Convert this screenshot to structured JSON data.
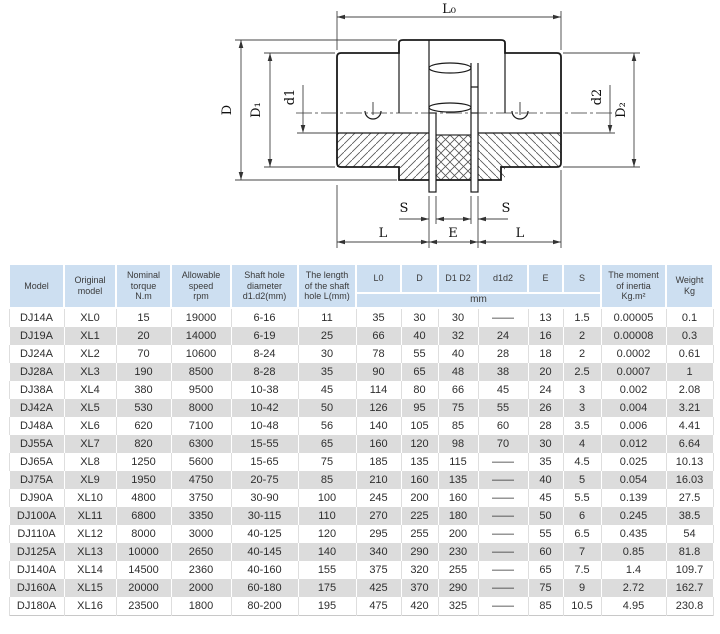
{
  "drawing": {
    "labels": {
      "l0": "L₀",
      "D": "D",
      "D1": "D₁",
      "d1": "d1",
      "d2": "d2",
      "D2": "D₂",
      "S": "S",
      "E": "E",
      "L": "L"
    }
  },
  "table": {
    "headers": {
      "model": "Model",
      "original_model": "Original\nmodel",
      "nominal_torque": "Nominal\ntorque\nN.m",
      "allowable_speed": "Allowable\nspeed\nrpm",
      "shaft_hole": "Shaft hole\ndiameter\nd1.d2(mm)",
      "shaft_length": "The length\nof the shaft\nhole L(mm)",
      "dims": [
        "L0",
        "D",
        "D1 D2",
        "d1d2",
        "E",
        "S"
      ],
      "dims_unit": "mm",
      "inertia": "The moment\nof inertia\nKg.m²",
      "weight": "Weight\nKg"
    },
    "rows": [
      [
        "DJ14A",
        "XL0",
        "15",
        "19000",
        "6-16",
        "11",
        "35",
        "30",
        "30",
        "——",
        "13",
        "1.5",
        "0.00005",
        "0.1"
      ],
      [
        "DJ19A",
        "XL1",
        "20",
        "14000",
        "6-19",
        "25",
        "66",
        "40",
        "32",
        "24",
        "16",
        "2",
        "0.00008",
        "0.3"
      ],
      [
        "DJ24A",
        "XL2",
        "70",
        "10600",
        "8-24",
        "30",
        "78",
        "55",
        "40",
        "28",
        "18",
        "2",
        "0.0002",
        "0.61"
      ],
      [
        "DJ28A",
        "XL3",
        "190",
        "8500",
        "8-28",
        "35",
        "90",
        "65",
        "48",
        "38",
        "20",
        "2.5",
        "0.0007",
        "1"
      ],
      [
        "DJ38A",
        "XL4",
        "380",
        "9500",
        "10-38",
        "45",
        "114",
        "80",
        "66",
        "45",
        "24",
        "3",
        "0.002",
        "2.08"
      ],
      [
        "DJ42A",
        "XL5",
        "530",
        "8000",
        "10-42",
        "50",
        "126",
        "95",
        "75",
        "55",
        "26",
        "3",
        "0.004",
        "3.21"
      ],
      [
        "DJ48A",
        "XL6",
        "620",
        "7100",
        "10-48",
        "56",
        "140",
        "105",
        "85",
        "60",
        "28",
        "3.5",
        "0.006",
        "4.41"
      ],
      [
        "DJ55A",
        "XL7",
        "820",
        "6300",
        "15-55",
        "65",
        "160",
        "120",
        "98",
        "70",
        "30",
        "4",
        "0.012",
        "6.64"
      ],
      [
        "DJ65A",
        "XL8",
        "1250",
        "5600",
        "15-65",
        "75",
        "185",
        "135",
        "115",
        "——",
        "35",
        "4.5",
        "0.025",
        "10.13"
      ],
      [
        "DJ75A",
        "XL9",
        "1950",
        "4750",
        "20-75",
        "85",
        "210",
        "160",
        "135",
        "——",
        "40",
        "5",
        "0.054",
        "16.03"
      ],
      [
        "DJ90A",
        "XL10",
        "4800",
        "3750",
        "30-90",
        "100",
        "245",
        "200",
        "160",
        "——",
        "45",
        "5.5",
        "0.139",
        "27.5"
      ],
      [
        "DJ100A",
        "XL11",
        "6800",
        "3350",
        "30-115",
        "110",
        "270",
        "225",
        "180",
        "——",
        "50",
        "6",
        "0.245",
        "38.5"
      ],
      [
        "DJ110A",
        "XL12",
        "8000",
        "3000",
        "40-125",
        "120",
        "295",
        "255",
        "200",
        "——",
        "55",
        "6.5",
        "0.435",
        "54"
      ],
      [
        "DJ125A",
        "XL13",
        "10000",
        "2650",
        "40-145",
        "140",
        "340",
        "290",
        "230",
        "——",
        "60",
        "7",
        "0.85",
        "81.8"
      ],
      [
        "DJ140A",
        "XL14",
        "14500",
        "2360",
        "40-160",
        "155",
        "375",
        "320",
        "255",
        "——",
        "65",
        "7.5",
        "1.4",
        "109.7"
      ],
      [
        "DJ160A",
        "XL15",
        "20000",
        "2000",
        "60-180",
        "175",
        "425",
        "370",
        "290",
        "——",
        "75",
        "9",
        "2.72",
        "162.7"
      ],
      [
        "DJ180A",
        "XL16",
        "23500",
        "1800",
        "80-200",
        "195",
        "475",
        "420",
        "325",
        "——",
        "85",
        "10.5",
        "4.95",
        "230.8"
      ]
    ]
  },
  "colors": {
    "header_bg": "#cddff1",
    "row_alt_bg": "#dcdcdc",
    "line": "#1a1a1a"
  }
}
